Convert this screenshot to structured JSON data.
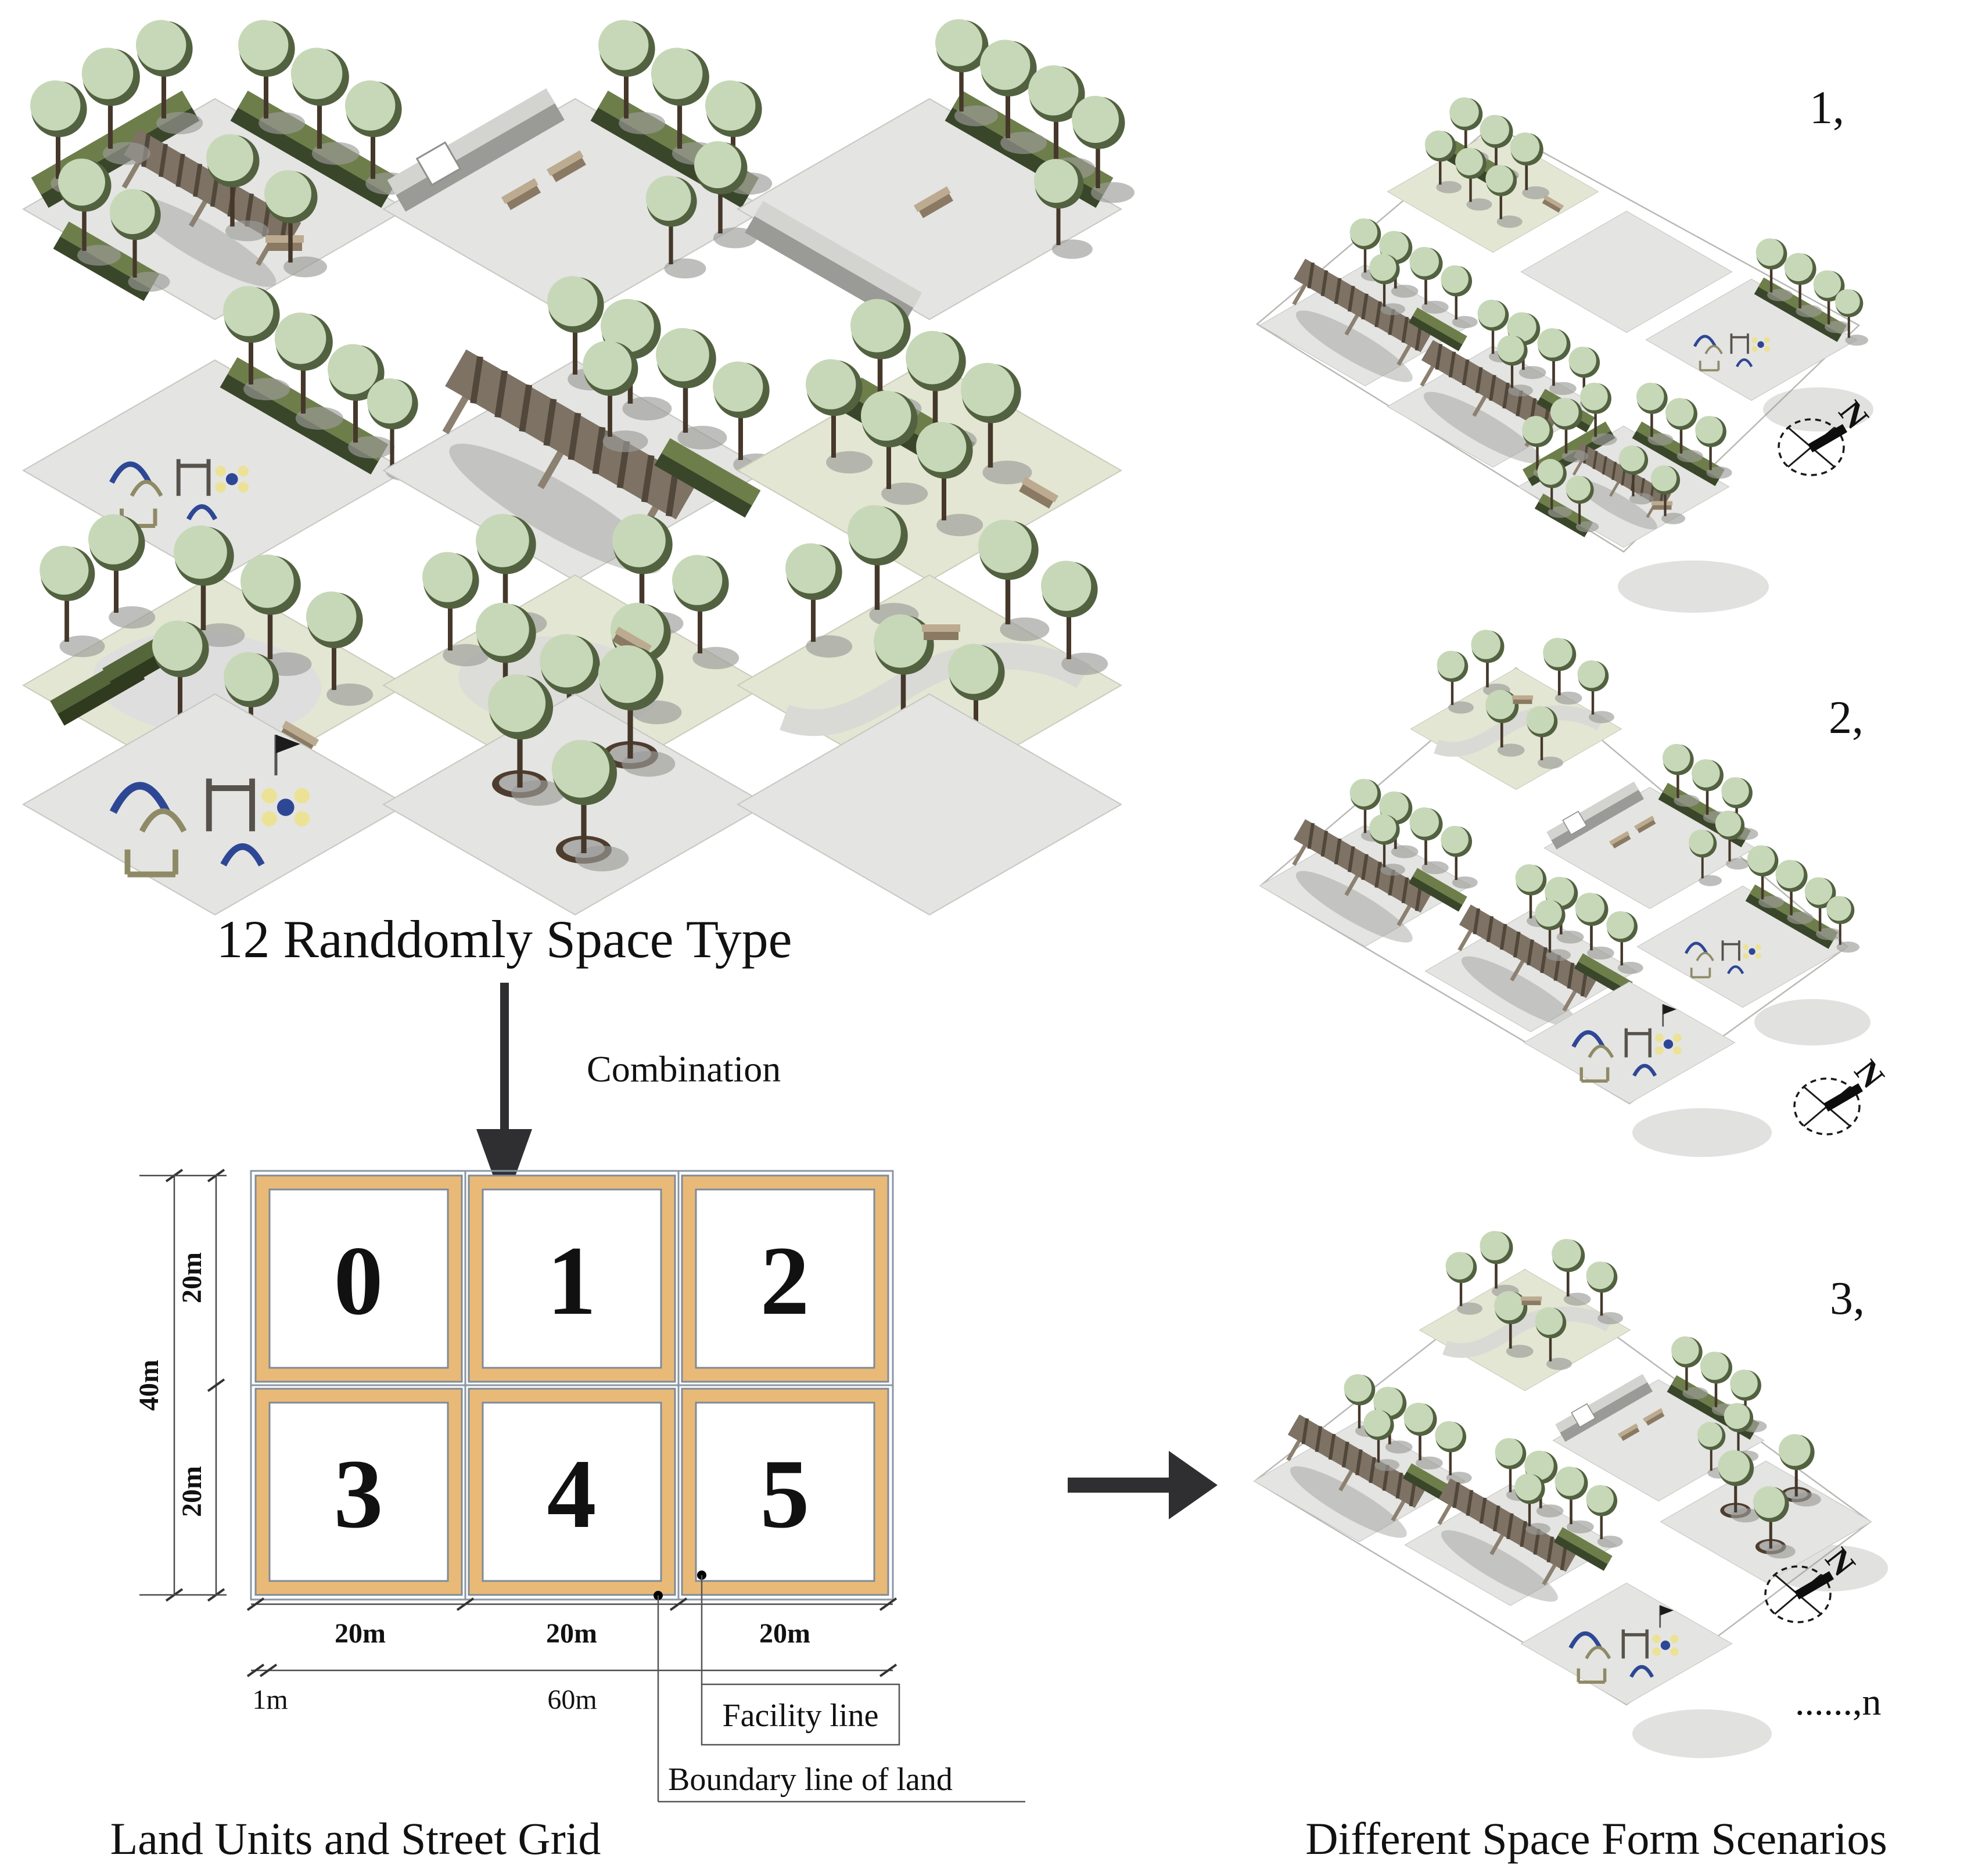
{
  "labels": {
    "space_types_title": "12 Randdomly Space Type",
    "combination": "Combination",
    "caption_left": "Land Units and Street Grid",
    "caption_right": "Different Space Form Scenarios",
    "facility_line": "Facility line",
    "boundary_line": "Boundary line of land",
    "ellipsis_n": "......,n"
  },
  "grid": {
    "cells": [
      "0",
      "1",
      "2",
      "3",
      "4",
      "5"
    ],
    "dims": {
      "v_total": "40m",
      "v_seg": "20m",
      "h_seg": "20m",
      "h_margin": "1m",
      "h_total": "60m"
    }
  },
  "scenarios": [
    {
      "label": "1,"
    },
    {
      "label": "2,"
    },
    {
      "label": "3,"
    }
  ],
  "compass": {
    "letter": "N"
  },
  "space_types": [
    "pergola courtyard with hedges and trees",
    "walled court with hedge, trees and benches",
    "front wall with back hedge and trees",
    "playground with hedge and trees",
    "large pergola with hedge and trees",
    "double tree rows with hedge strip",
    "green bench boxes with scattered trees",
    "tree ring around paved patch",
    "winding path with trees",
    "playground equipment plaza",
    "three potted trees plaza",
    "empty paved plaza"
  ],
  "colors": {
    "facility_band": "#e9ba77",
    "street_line": "#8a96a3",
    "hedge_top": "#6d7e4b",
    "hedge_side": "#39462a",
    "tree_light": "#c7d8b8",
    "tree_shade": "#52613f",
    "ground_grey": "#e4e4e2",
    "ground_green": "#e3e6d2",
    "wall_grey": "#9a9a97",
    "pergola_brown": "#7d7264",
    "play_blue": "#2e4795",
    "play_yellow": "#ece295",
    "bench_tan": "#bcab90",
    "arrow_dark": "#2f2f31"
  }
}
